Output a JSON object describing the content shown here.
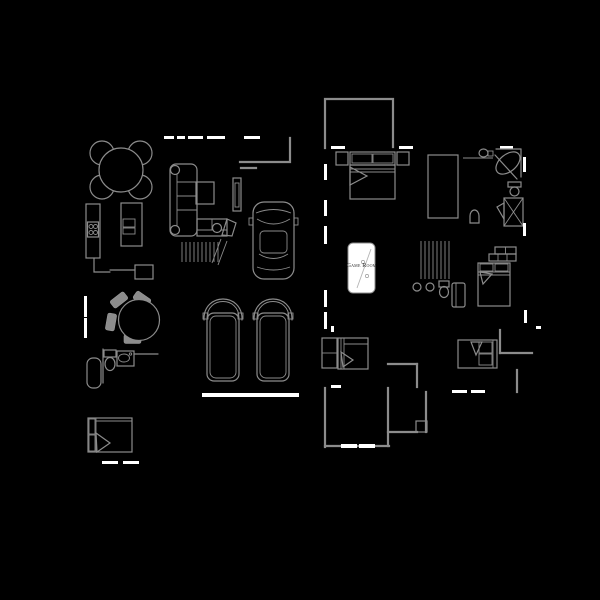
{
  "scene": {
    "type": "floor-plan",
    "background": "#000000",
    "wall_color": "#8c8c8c",
    "furniture_color": "#8c8c8c",
    "window_color": "#ffffff",
    "pool_table_fill": "#ffffff",
    "label_color": "#2b2b2b"
  },
  "labels": {
    "game_room": "Game Room"
  },
  "inventory": [
    "breakfast-table",
    "breakfast-chairs",
    "kitchen-counter",
    "cooktop",
    "kitchen-island",
    "island-sink",
    "kitchen-desk",
    "sectional-sofa",
    "sofa-end-tables",
    "coffee-table",
    "tv-console",
    "staircase",
    "driveway-car",
    "garage-car-left",
    "garage-car-right",
    "garage-door",
    "master-bed",
    "nightstands",
    "walk-in-closet",
    "vanity-sink",
    "corner-bathtub",
    "toilet",
    "shower-stall",
    "pool-table",
    "clothes-hangers",
    "wall-shelf",
    "bed-right",
    "bed-middle",
    "dresser",
    "bed-bottom-right",
    "dining-table",
    "dining-chairs",
    "hall-bathtub",
    "hall-toilet",
    "hall-sink",
    "bed-bottom-left",
    "window-segments",
    "interior-dashed-wall"
  ]
}
